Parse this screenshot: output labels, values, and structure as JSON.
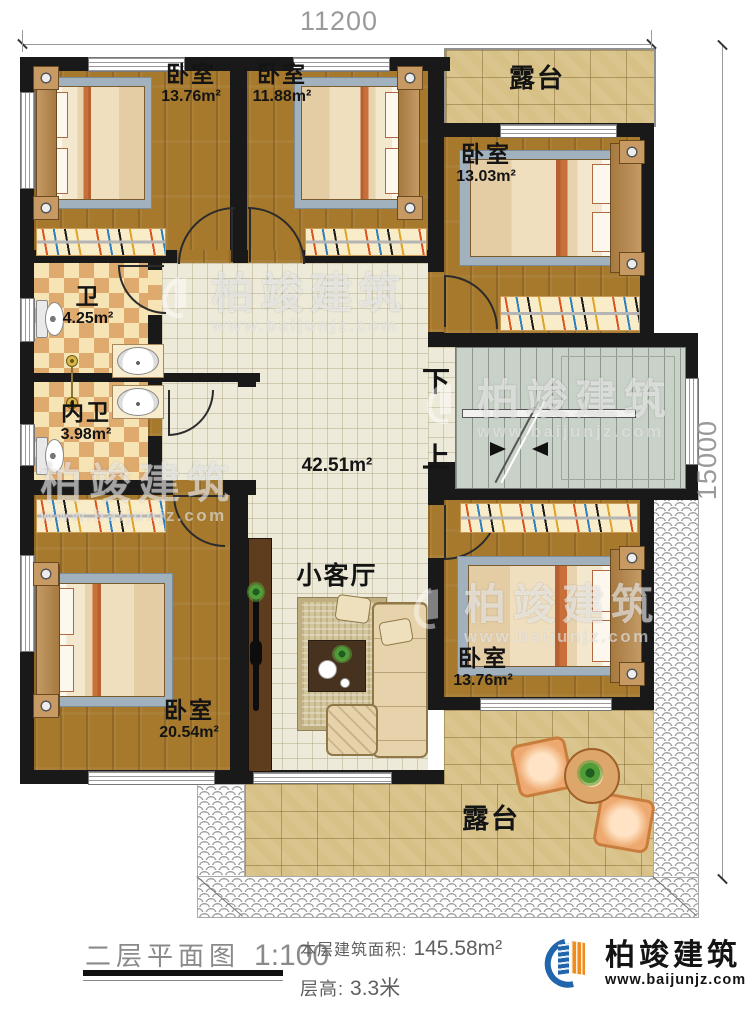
{
  "dimensions": {
    "width": "11200",
    "height": "15000"
  },
  "rooms": {
    "bedroom_top_left": {
      "name": "卧室",
      "area": "13.76m²"
    },
    "bedroom_top_middle": {
      "name": "卧室",
      "area": "11.88m²"
    },
    "terrace_top": {
      "name": "露台"
    },
    "bedroom_top_right": {
      "name": "卧室",
      "area": "13.03m²"
    },
    "bathroom": {
      "name": "卫",
      "area": "4.25m²"
    },
    "inner_bathroom": {
      "name": "内卫",
      "area": "3.98m²"
    },
    "living_room": {
      "name": "小客厅",
      "area": "42.51m²"
    },
    "bedroom_bottom_left": {
      "name": "卧室",
      "area": "20.54m²"
    },
    "bedroom_bottom_right": {
      "name": "卧室",
      "area": "13.76m²"
    },
    "terrace_bottom": {
      "name": "露台"
    }
  },
  "stairs": {
    "down_label": "下",
    "up_label": "上"
  },
  "legend": {
    "title": "二层平面图",
    "scale": "1:100",
    "floor_area_label": "本层建筑面积:",
    "floor_area_value": "145.58m²",
    "floor_height_label": "层高:",
    "floor_height_value": "3.3米"
  },
  "brand": {
    "name": "柏竣建筑",
    "website": "www.baijunjz.com"
  },
  "watermark": {
    "name": "柏竣建筑",
    "website": "www.baijunjz.com"
  },
  "colors": {
    "wall": "#191919",
    "wood": "#a6792d",
    "tile": "#edead9",
    "stair": "#c9d2c8",
    "terrace": "#d7c186",
    "brand_blue": "#2165ad",
    "brand_orange": "#f08c1e"
  }
}
